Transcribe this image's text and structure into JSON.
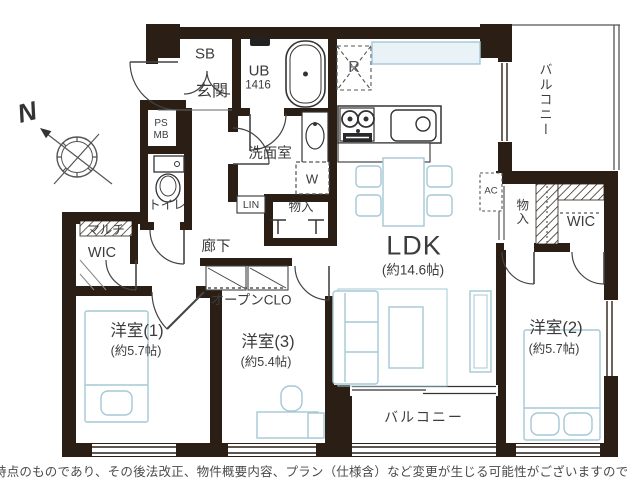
{
  "plan": {
    "compass": {
      "north": "N"
    },
    "labels": {
      "sb": "SB",
      "genkan": "玄関",
      "ub": "UB",
      "ub_size": "1416",
      "fridge": "R",
      "washroom": "洗面室",
      "washer": "W",
      "ps": "PS",
      "mb": "MB",
      "toilet": "トイレ",
      "multi_wic_line1": "マルチ",
      "multi_wic_line2": "WIC",
      "linen": "LIN",
      "storage_hall": "物入",
      "corridor": "廊下",
      "open_closet": "オープンCLO",
      "ldk": "LDK",
      "ldk_size": "(約14.6帖)",
      "bedroom1": "洋室(1)",
      "bedroom1_size": "(約5.7帖)",
      "bedroom3": "洋室(3)",
      "bedroom3_size": "(約5.4帖)",
      "bedroom2": "洋室(2)",
      "bedroom2_size": "(約5.7帖)",
      "balcony_side": "バルコニー",
      "storage_east": "物入",
      "wic": "WIC",
      "ac": "AC",
      "balcony_south": "バルコニー"
    },
    "footer_note": "時点のものであり、その後法改正、物件概要内容、プラン（仕様含）など変更が生じる可能性がございますので、ご購入時"
  },
  "colors": {
    "wall": "#2a1e15",
    "furniture": "#a5c8d6",
    "text": "#3c3c3c"
  }
}
